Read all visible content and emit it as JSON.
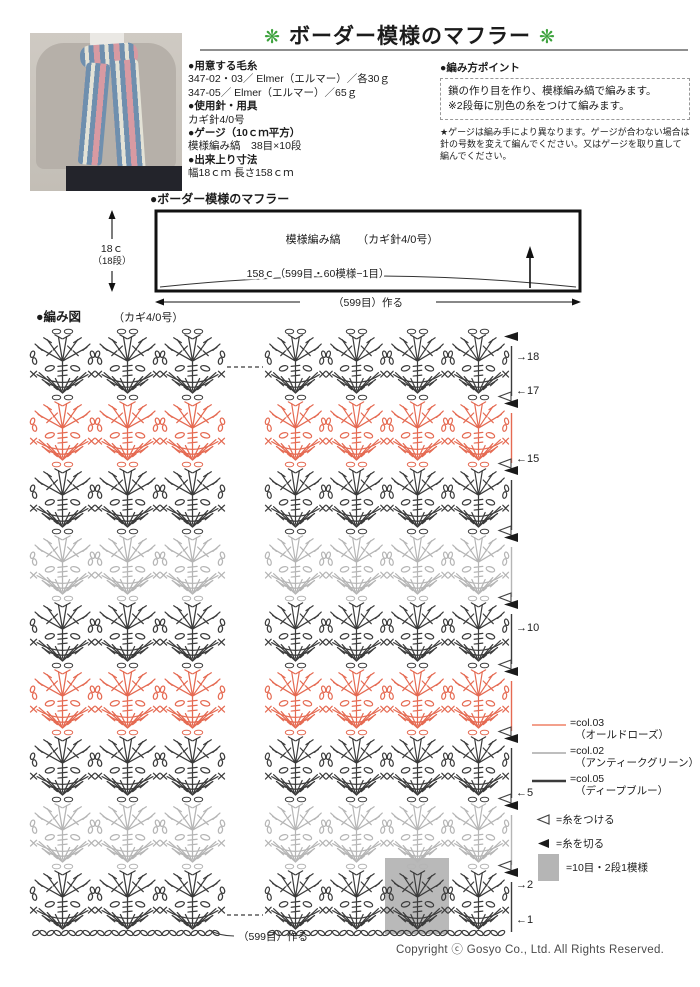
{
  "title": {
    "flower": "❋",
    "text": "ボーダー模様のマフラー"
  },
  "materials": {
    "yarn_header": "●用意する毛糸",
    "yarn_lines": [
      "347-02・03／ Elmer（エルマー）／各30ｇ",
      "347-05／ Elmer（エルマー）／65ｇ"
    ],
    "needle_header": "●使用針・用具",
    "needle_line": "カギ針4/0号",
    "gauge_header": "●ゲージ（10ｃｍ平方）",
    "gauge_line": "模様編み縞　38目×10段",
    "size_header": "●出来上り寸法",
    "size_line": "幅18ｃｍ 長さ158ｃｍ"
  },
  "points": {
    "header": "●編み方ポイント",
    "boxed": [
      "鎖の作り目を作り、模様編み縞で編みます。",
      "※2段毎に別色の糸をつけて編みます。"
    ],
    "note": "★ゲージは編み手により異なります。ゲージが合わない場合は針の号数を変えて編んでください。又はゲージを取り直して編んでください。"
  },
  "schematic": {
    "header": "●ボーダー模様のマフラー",
    "inner_label": "模様編み縞　　（カギ針4/0号）",
    "length_label": "158ｃ（599目・60模様−1目）",
    "height_label": "18ｃ",
    "height_sub": "（18段）",
    "bottom_label": "（599目）作る"
  },
  "chart": {
    "header": "●編み図",
    "hook_label": "（カギ4/0号）",
    "bands": [
      {
        "color": "col.05"
      },
      {
        "color": "col.03"
      },
      {
        "color": "col.05"
      },
      {
        "color": "col.02"
      },
      {
        "color": "col.05"
      },
      {
        "color": "col.03"
      },
      {
        "color": "col.05"
      },
      {
        "color": "col.02"
      },
      {
        "color": "col.05"
      }
    ],
    "palette": {
      "col.05": "#3b3b3b",
      "col.03": "#e56a52",
      "col.02": "#b5b5b5"
    },
    "row_markers": [
      {
        "label": "→18",
        "y": 356
      },
      {
        "label": "←17",
        "y": 390
      },
      {
        "label": "←15",
        "y": 458
      },
      {
        "label": "→10",
        "y": 627
      },
      {
        "label": "←5",
        "y": 792
      },
      {
        "label": "→2",
        "y": 884
      },
      {
        "label": "←1",
        "y": 919
      }
    ],
    "foundation_label": "（599目）作る"
  },
  "legend": {
    "colors": [
      {
        "name": "=col.03",
        "jp": "（オールドローズ）",
        "hex": "#ef8166",
        "weight": 1.6
      },
      {
        "name": "=col.02",
        "jp": "（アンティークグリーン）",
        "hex": "#a9a9a9",
        "weight": 1.6
      },
      {
        "name": "=col.05",
        "jp": "（ディープブルー）",
        "hex": "#3b3b3b",
        "weight": 2.4
      }
    ],
    "attach": "=糸をつける",
    "cut": "=糸を切る",
    "unit": "=10目・2段1模様"
  },
  "copyright": "Copyright ⓒ Gosyo Co., Ltd. All Rights Reserved."
}
